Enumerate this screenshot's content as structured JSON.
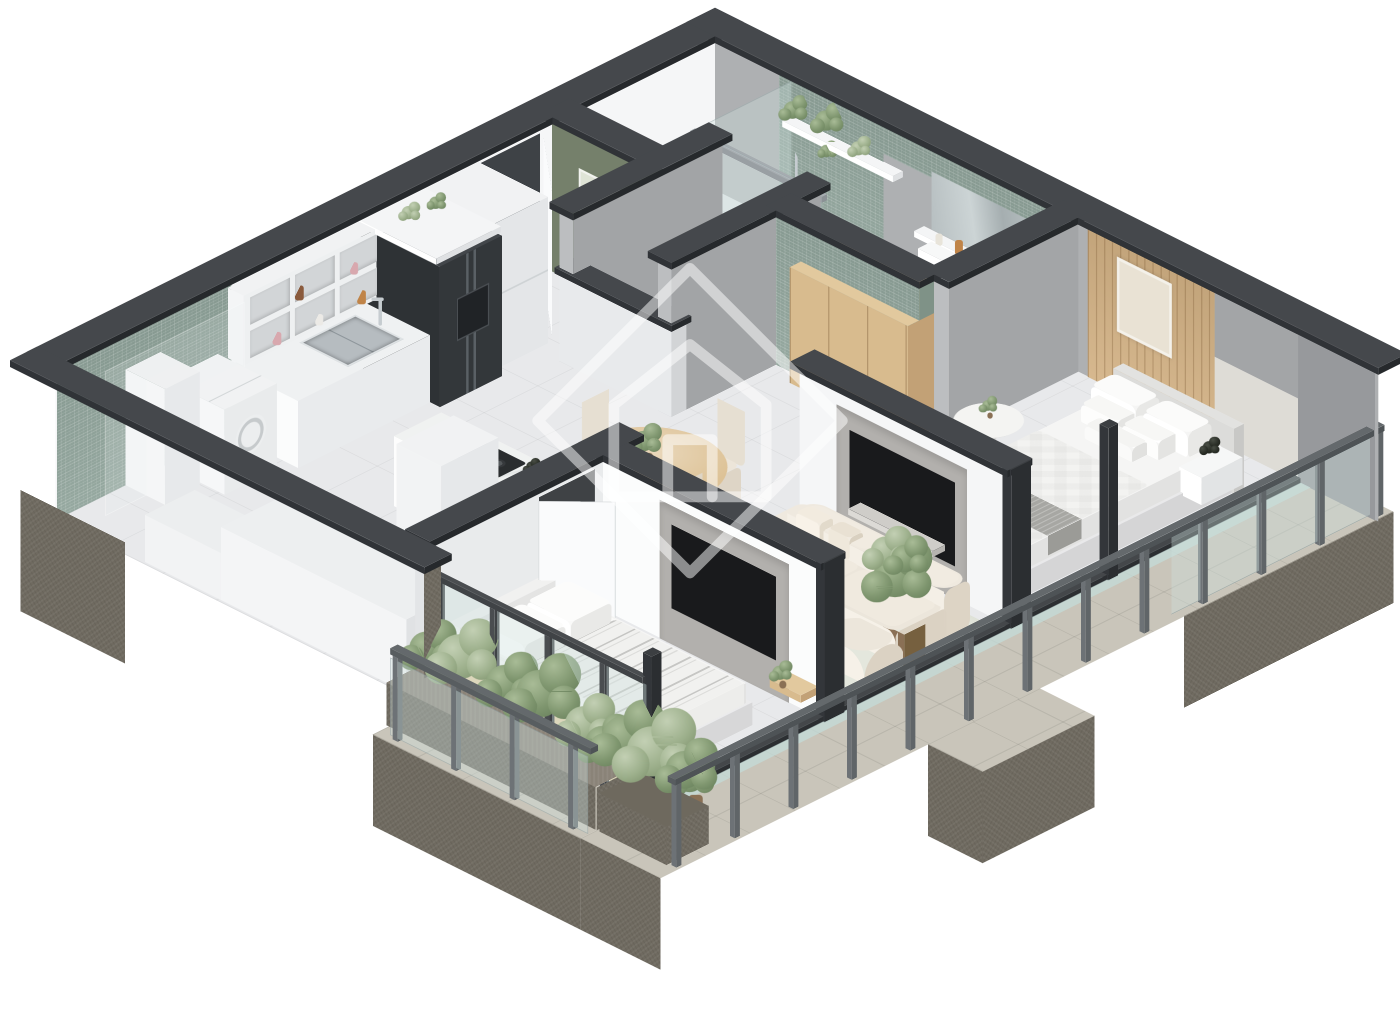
{
  "scene": {
    "type": "isometric-3d-floor-plan-render",
    "background": "#ffffff",
    "watermark": "diamond-house-logo-outline"
  },
  "palette": {
    "cap_top": "#45484c",
    "cap_side": "#303337",
    "cap_edge": "#26292c",
    "concrete": "#6f6a60",
    "concrete_light": "#8a8378",
    "stone_floor": "#c9c5ba",
    "wall_white": "#f5f6f7",
    "wall_white_shade": "#d7d9db",
    "wall_gray": "#bcbec0",
    "wall_gray_shade": "#a2a4a6",
    "wall_gray_panel": "#a7a9ab",
    "wall_gray_panel_dark": "#97999c",
    "headboard_band": "#dedcd6",
    "tile_green": "#8fa39a",
    "olive_wall": "#75806b",
    "olive_dark": "#66715d",
    "wood": "#d8bb8e",
    "wood_side": "#c2a176",
    "wood_top": "#e2c99e",
    "wood_floor": "#e6d2a8",
    "floor_tile": "#e8e9eb",
    "rug": "#e4e7dd",
    "glass_tint": "rgba(205,224,222,0.38)",
    "glass_floor": "rgba(196,220,217,0.72)",
    "tv_black": "#191a1c",
    "media_gray": "#b2b0ad",
    "fridge": "#33373a",
    "steel": "#b6bcc0",
    "chrome": "#c6ccd0",
    "basin_green": "#aebfae",
    "sofa_cream": "#efe9df",
    "sofa_cream_dark": "#ddd4c5",
    "chair_cream": "#ece5d9",
    "bed_white": "#f5f5f4",
    "duvet_stripe": "#c6c6c3",
    "throw_gray": "#a7a7a3",
    "plant_light": "#a9bc97",
    "plant_green": "#7f966f",
    "plant_dark": "#647c58",
    "plant_black_1": "#4a4f46",
    "plant_black_2": "#2a2e27",
    "pot_brown": "#8a7055",
    "planter": "#6e695e",
    "watermark_stroke": "rgba(255,255,255,0.5)"
  },
  "rooms": [
    {
      "id": "kitchen",
      "label": "Kitchen",
      "furniture": [
        "open-shelves",
        "sink-counter",
        "refrigerator",
        "tall-cabinet",
        "island-cooktop"
      ]
    },
    {
      "id": "entry",
      "label": "Entry",
      "furniture": [
        "entry-door",
        "olive-accent-wall",
        "wall-art"
      ]
    },
    {
      "id": "wc",
      "label": "Guest WC",
      "furniture": [
        "toilet",
        "green-vessel-basin"
      ]
    },
    {
      "id": "shower-room",
      "label": "Shower Room",
      "furniture": [
        "glass-screen",
        "shower-set",
        "plant-shelf"
      ]
    },
    {
      "id": "bathroom",
      "label": "Ensuite Bathroom",
      "furniture": [
        "toilet",
        "wood-vanity",
        "mirror-cabinet"
      ]
    },
    {
      "id": "master-bedroom",
      "label": "Master Bedroom",
      "furniture": [
        "double-bed",
        "floating-nightstand",
        "wardrobe",
        "wood-slat-wall",
        "round-side-table",
        "tv-panel"
      ]
    },
    {
      "id": "living-room",
      "label": "Living Room",
      "furniture": [
        "curved-sofa",
        "rug",
        "side-table",
        "tall-plant",
        "media-wall"
      ]
    },
    {
      "id": "dining-area",
      "label": "Dining Area",
      "furniture": [
        "round-table",
        "dining-chairs",
        "plant-centerpiece"
      ]
    },
    {
      "id": "bedroom-2",
      "label": "Second Bedroom",
      "furniture": [
        "bed-striped-duvet",
        "tv-media-panel",
        "wood-shelf",
        "glass-wall"
      ]
    },
    {
      "id": "balcony",
      "label": "Balcony",
      "furniture": [
        "glass-balustrade",
        "stone-deck",
        "concrete-planter",
        "shrubs"
      ]
    },
    {
      "id": "utility",
      "label": "Utility Area",
      "furniture": [
        "washer",
        "water-heater",
        "storage-ledges",
        "green-tile-wall"
      ]
    }
  ]
}
